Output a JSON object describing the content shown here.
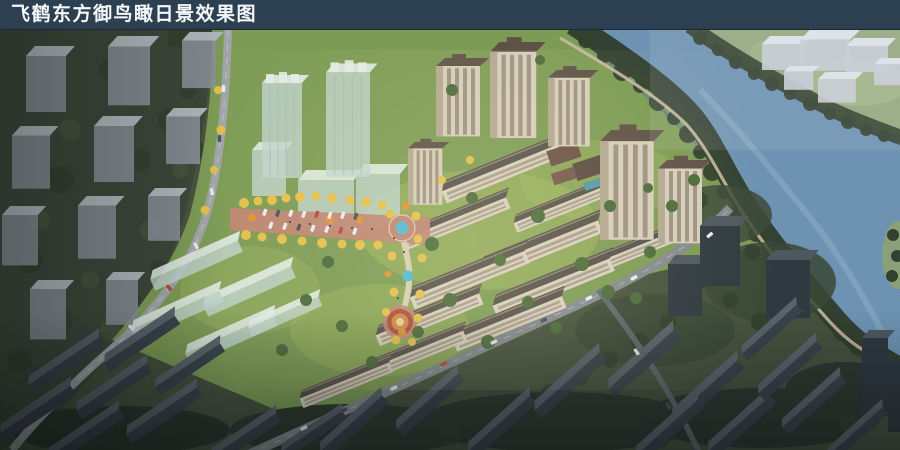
{
  "window": {
    "width": 900,
    "height": 450
  },
  "title_bar": {
    "text": "飞鹤东方御鸟瞰日景效果图",
    "background_color": "#2c4052",
    "text_color": "#f5f8fa"
  },
  "scene": {
    "type": "aerial-architectural-rendering",
    "time_of_day": "day",
    "features": [
      "context-city-blocks-left",
      "north-tree-belt",
      "glass-massing-towers",
      "residential-highrise-towers",
      "midrise-apartment-rows",
      "glass-massing-rows",
      "entrance-boulevard-parking",
      "fountain-plaza",
      "landscape-axis",
      "mandala-plaza",
      "west-boundary-road",
      "south-boundary-road",
      "river",
      "riverside-promenade",
      "riverbank-trees",
      "far-bank-massing-blocks",
      "dark-context-towers",
      "dark-context-rows"
    ],
    "colors": {
      "water": "#6d92b2",
      "water_highlight": "#a3c3d8",
      "site_lawn": "#7c9b55",
      "lawn_light": "#a5ba62",
      "site_tree": "#4b6b3b",
      "context_tree": "#3a463a",
      "autumn_yellow": "#e3c04c",
      "autumn_orange": "#dc9434",
      "facade_cream": "#d6cdbb",
      "roof_dark": "#57514a",
      "glass_massing": "#bfd3cd",
      "context_block": "#8a929a",
      "faded_block": "#c5ccd4",
      "dark_block": "#39434b",
      "road_light": "#a0a5a8",
      "road_mid": "#83898e",
      "plaza_paving": "#c08573",
      "pool_blue": "#52b8d4",
      "far_bank": "#93a77e"
    }
  }
}
